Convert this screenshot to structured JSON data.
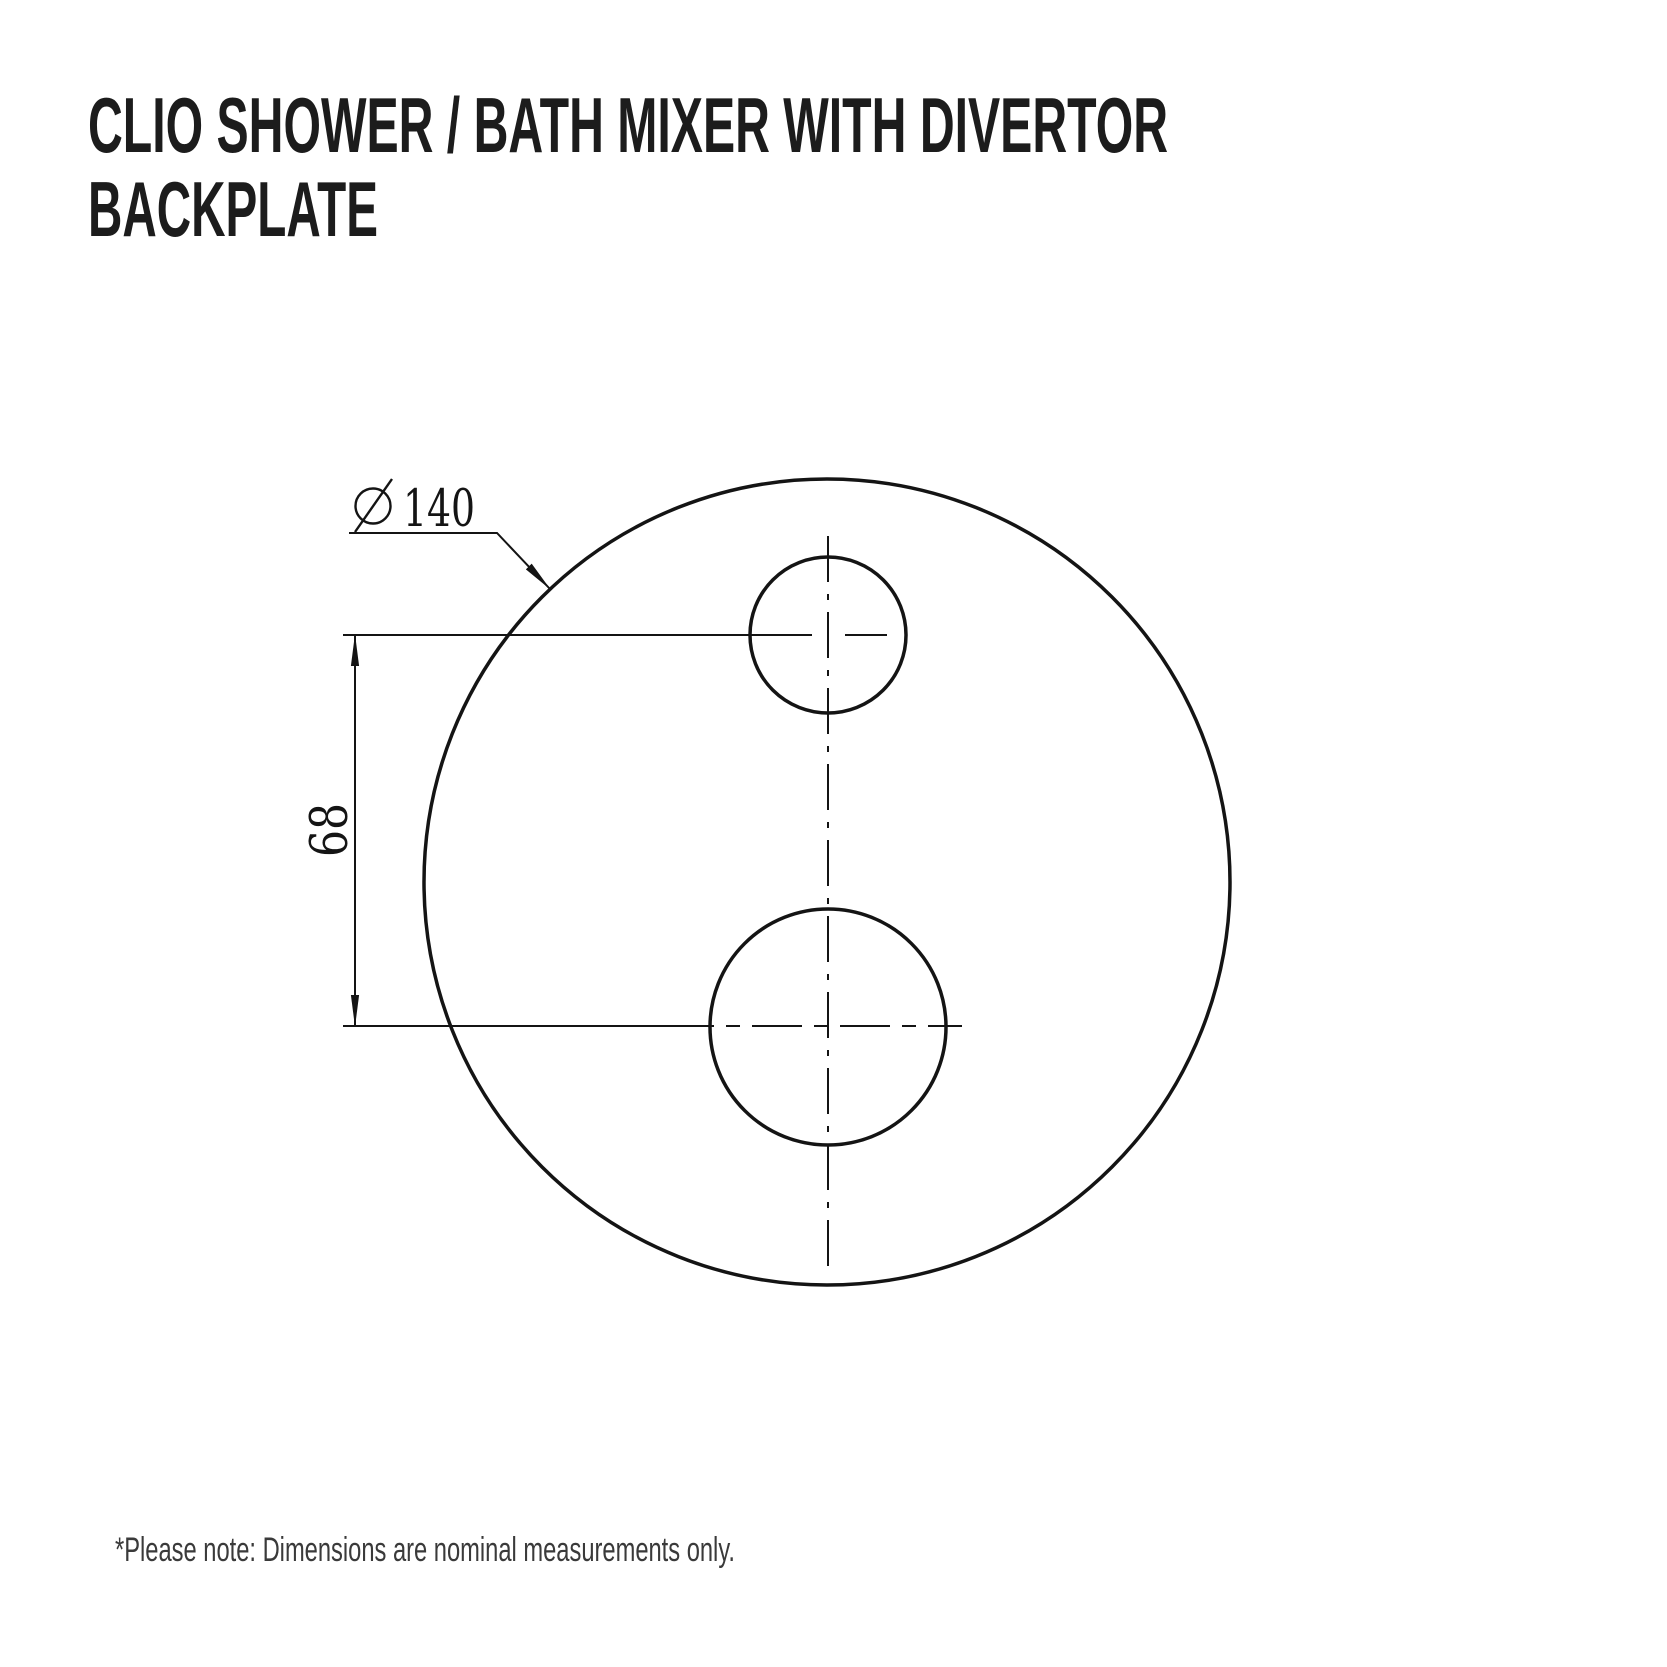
{
  "title": {
    "line1": "CLIO SHOWER / BATH MIXER WITH DIVERTOR",
    "line2": "BACKPLATE"
  },
  "drawing": {
    "type": "technical-dimension-drawing",
    "view": "front view of round backplate with small divertor hole above large mixer hole",
    "diameter_symbol": "⌀",
    "diameter_value": "140",
    "hole_spacing_value": "68"
  },
  "footer": {
    "note": "*Please note: Dimensions are nominal measurements only."
  },
  "colors": {
    "line": "#141414",
    "title_text": "#1c1c1c",
    "footer_text": "#3a3a3a",
    "background": "#ffffff"
  }
}
